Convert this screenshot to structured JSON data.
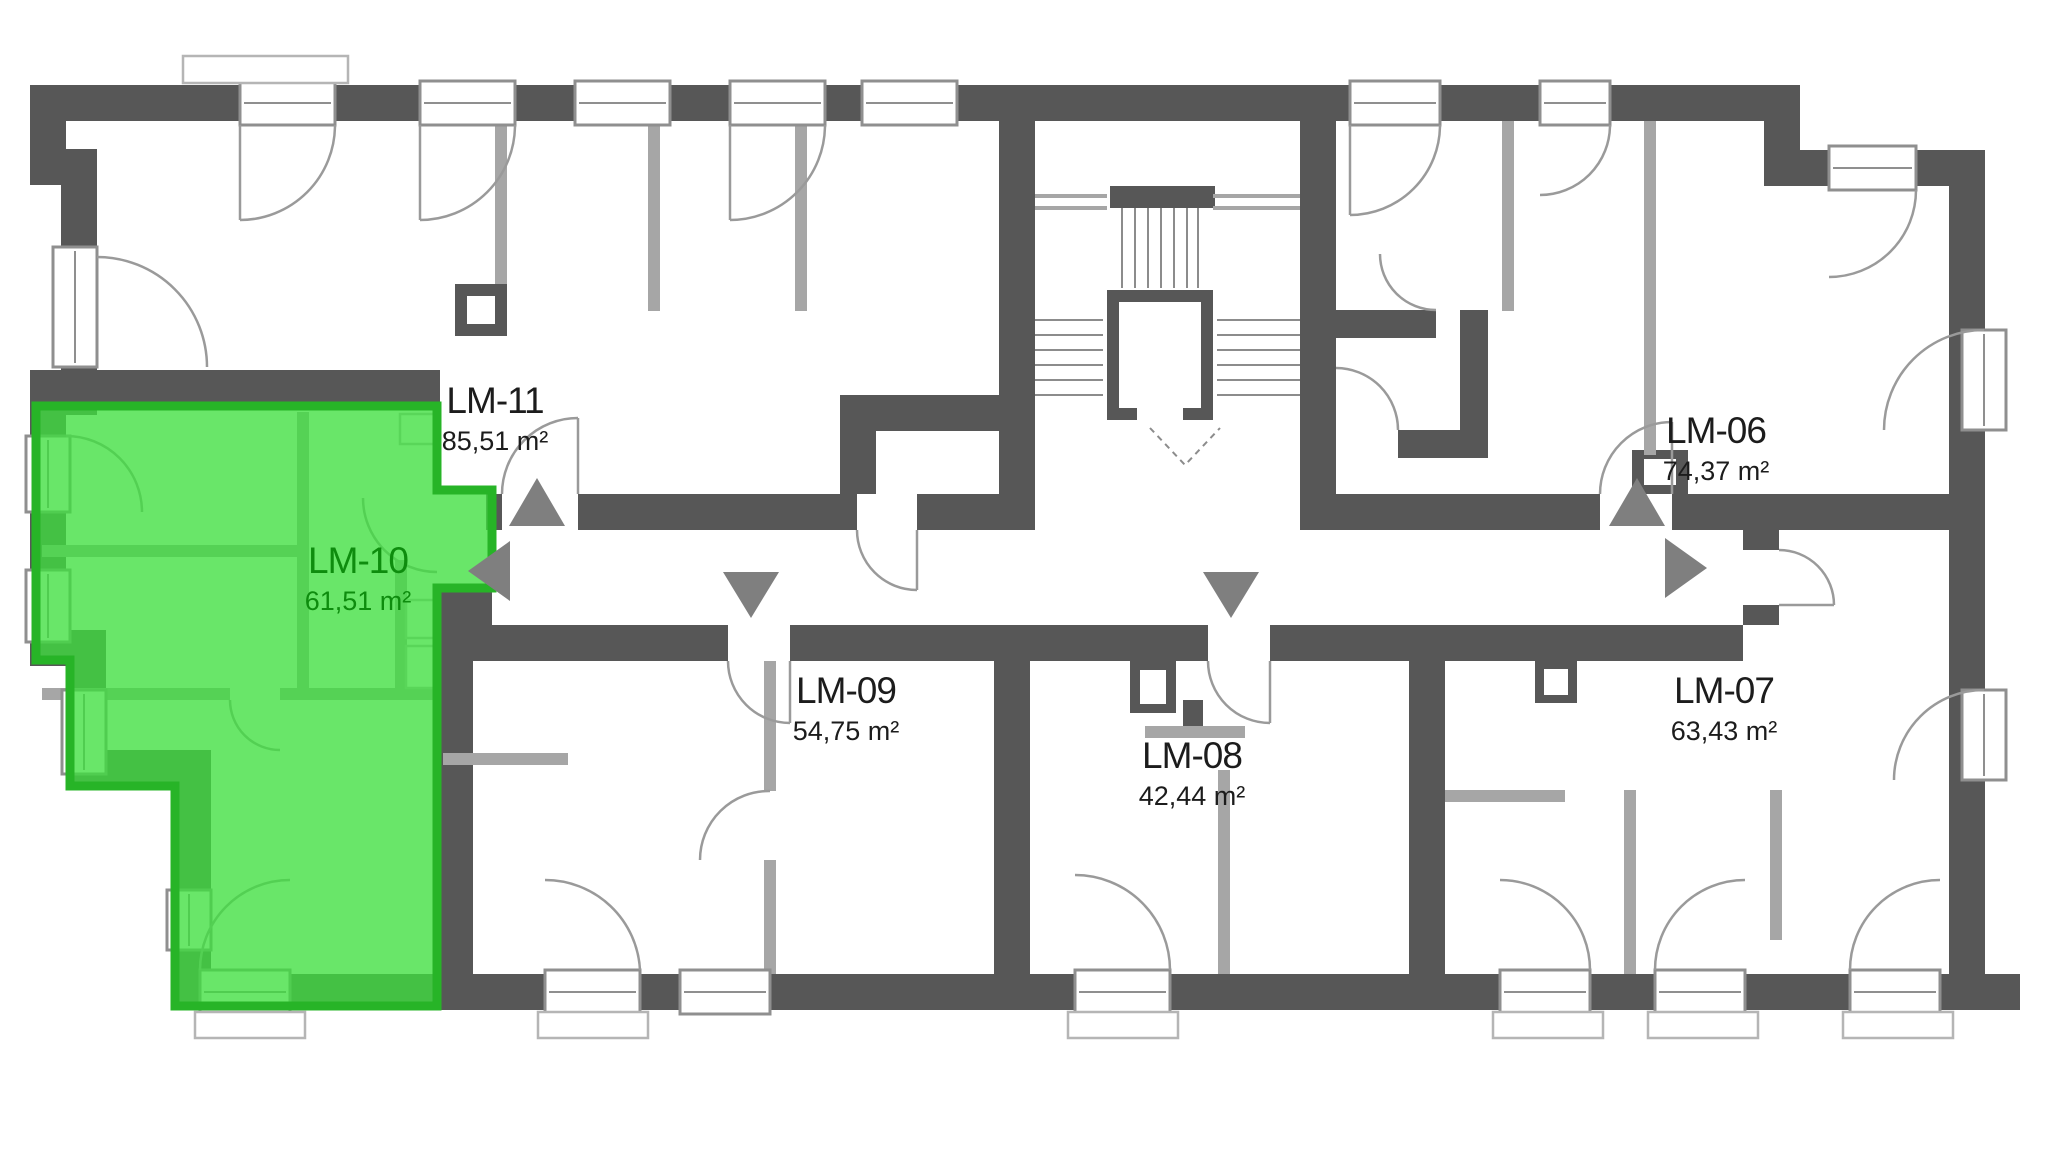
{
  "page": {
    "background": "#ffffff",
    "type": "apartment-floor-plan"
  },
  "colors": {
    "wall": "#575757",
    "partition": "#a6a6a6",
    "window_stroke": "#8f8f8f",
    "door_stroke": "#9a9a9a",
    "stair_stroke": "#8c8c8c",
    "fixture_stroke": "#b5b5b5",
    "arrow_fill": "#7f7f7f",
    "label_text": "#1c1c1c",
    "highlight_fill": "#3fdf3f",
    "highlight_border": "#27b427",
    "highlight_text": "#0e8c0e"
  },
  "apartments": [
    {
      "id": "LM-06",
      "area": "74,37 m²",
      "highlighted": false
    },
    {
      "id": "LM-07",
      "area": "63,43 m²",
      "highlighted": false
    },
    {
      "id": "LM-08",
      "area": "42,44 m²",
      "highlighted": false
    },
    {
      "id": "LM-09",
      "area": "54,75 m²",
      "highlighted": false
    },
    {
      "id": "LM-10",
      "area": "61,51 m²",
      "highlighted": true
    },
    {
      "id": "LM-11",
      "area": "85,51 m²",
      "highlighted": false
    }
  ]
}
